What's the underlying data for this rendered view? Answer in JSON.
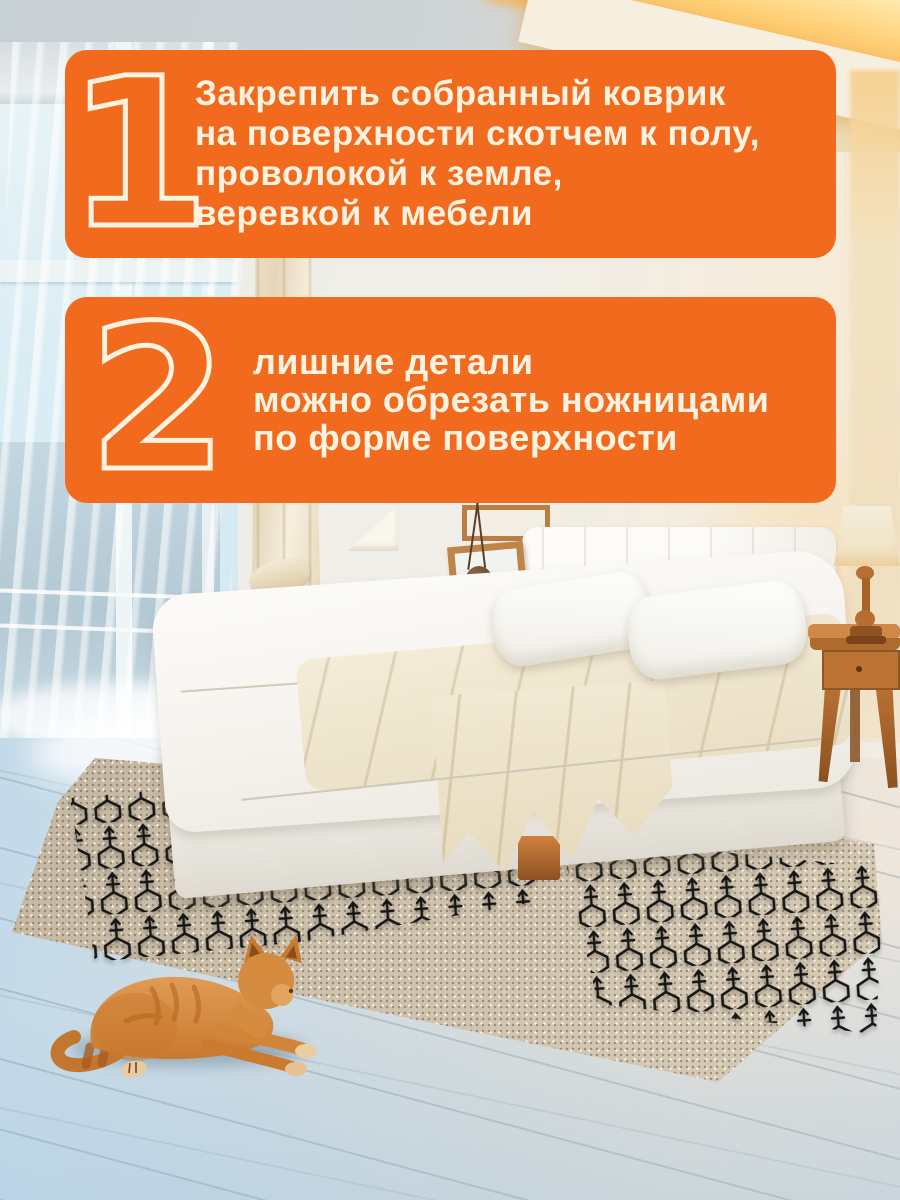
{
  "colors": {
    "accent": "#F26A1E",
    "card_text": "#FBF2DF"
  },
  "steps": [
    {
      "number": "1",
      "lines": [
        "Закрепить собранный коврик",
        "на поверхности скотчем к полу,",
        "проволокой к земле,",
        "веревкой к мебели"
      ]
    },
    {
      "number": "2",
      "lines": [
        "лишние детали",
        "можно обрезать ножницами",
        "по форме поверхности"
      ]
    }
  ]
}
